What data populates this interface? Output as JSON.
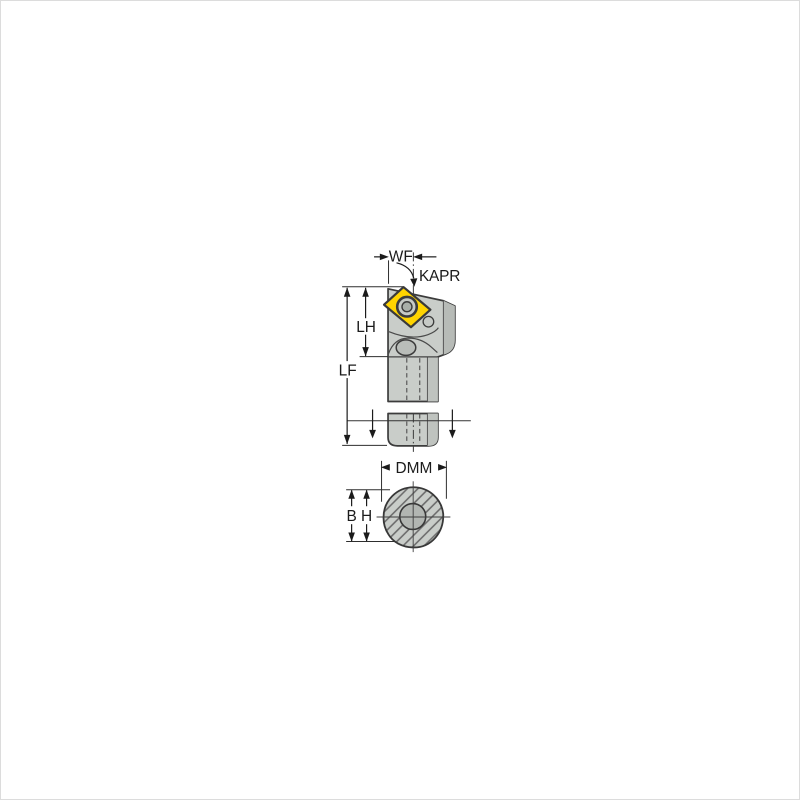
{
  "page": {
    "background": "#ffffff",
    "border_color": "#dcdcdc"
  },
  "drawing": {
    "name": "turning-tool-holder-dimension-drawing",
    "views": {
      "side_view_labels": {
        "wf": "WF",
        "kapr": "KAPR",
        "lh": "LH",
        "lf": "LF"
      },
      "section_view_labels": {
        "dmm": "DMM",
        "b": "B",
        "h": "H"
      }
    },
    "colors": {
      "body": "#c9cdc9",
      "body_shade": "#b7bbb7",
      "body_edge": "#bfc3bf",
      "insert": "#ffd400",
      "screw_outer": "#c6cac6",
      "screw_inner": "#a9afa9",
      "clamp": "#b9bdb9",
      "outline": "#3c3c3c",
      "dimension_line": "#1b1b1b",
      "hatch_line": "#6d6d6d",
      "hole_fill": "#b2b6b2"
    }
  }
}
